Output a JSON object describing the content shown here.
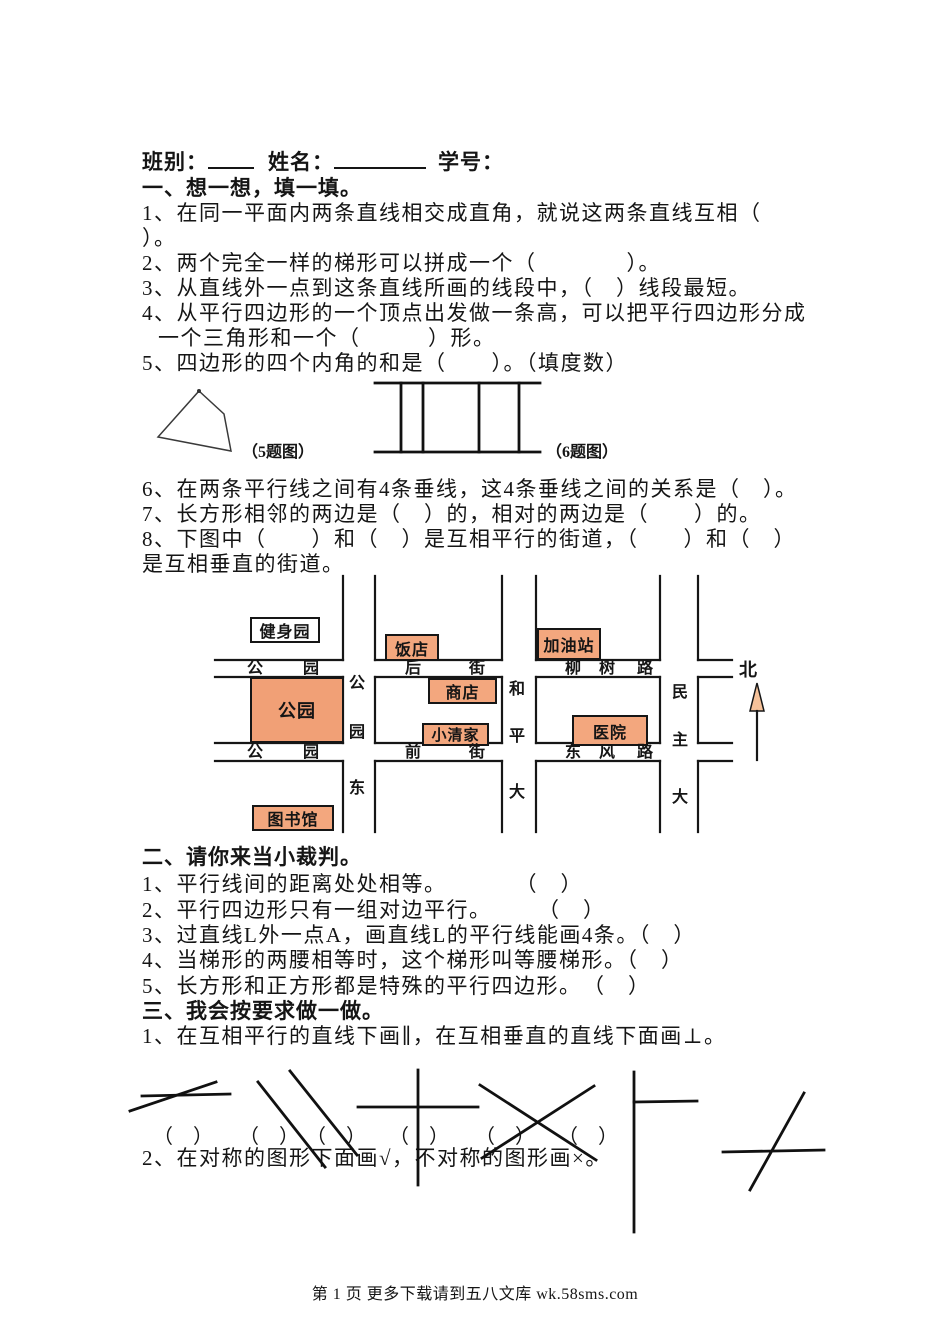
{
  "colors": {
    "building_fill": "#f3a77e",
    "park_fill": "#f1a076",
    "arrow_fill": "#f6c29a",
    "ink": "#151515"
  },
  "header": {
    "class_label": "班别：",
    "name_label": "姓名：",
    "student_label": "学号："
  },
  "s1": {
    "title": "一、想一想，填一填。",
    "q1a": "1、在同一平面内两条直线相交成直角，就说这两条直线互相（",
    "q1b": "）。",
    "q2": "2、两个完全一样的梯形可以拼成一个（　　　　）。",
    "q3": "3、从直线外一点到这条直线所画的线段中，（　）线段最短。",
    "q4a": "4、从平行四边形的一个顶点出发做一条高，可以把平行四边形分成",
    "q4b": "一个三角形和一个（　　　）形。",
    "q5": "5、四边形的四个内角的和是（　　）。（填度数）",
    "q6": "6、在两条平行线之间有4条垂线，这4条垂线之间的关系是（　）。",
    "q7": "7、长方形相邻的两边是（　）的，相对的两边是（　　）的。",
    "q8a": "8、下图中（　　）和（　）是互相平行的街道，（　　）和（　）",
    "q8b": "是互相垂直的街道。"
  },
  "figs": {
    "fig5_label": "（5题图）",
    "fig6_label": "（6题图）"
  },
  "map": {
    "north": "北",
    "h1": {
      "west": [
        "公",
        "园"
      ],
      "mid": [
        "后",
        "街"
      ],
      "east": [
        "柳",
        "树",
        "路"
      ]
    },
    "h2": {
      "west": [
        "公",
        "园"
      ],
      "mid": [
        "前",
        "街"
      ],
      "east": [
        "东",
        "风",
        "路"
      ]
    },
    "v1": [
      "公",
      "园",
      "东"
    ],
    "v2": [
      "和",
      "平",
      "大"
    ],
    "v3": [
      "民",
      "主",
      "大"
    ],
    "buildings": [
      {
        "name": "健身园"
      },
      {
        "name": "饭店"
      },
      {
        "name": "加油站"
      },
      {
        "name": "商店"
      },
      {
        "name": "公园"
      },
      {
        "name": "小清家"
      },
      {
        "name": "医院"
      },
      {
        "name": "图书馆"
      }
    ]
  },
  "s2": {
    "title": "二、请你来当小裁判。",
    "q1": "1、平行线间的距离处处相等。　　　　（　）",
    "q2": "2、平行四边形只有一组对边平行。　　　（　）",
    "q3": "3、过直线L外一点A，画直线L的平行线能画4条。（　）",
    "q4": "4、当梯形的两腰相等时，这个梯形叫等腰梯形。（　）",
    "q5": "5、长方形和正方形都是特殊的平行四边形。　（　）"
  },
  "s3": {
    "title": "三、我会按要求做一做。",
    "q1": "1、在互相平行的直线下画∥，在互相垂直的直线下面画⊥。",
    "paren": "（　）",
    "q2": "2、在对称的图形下面画√，不对称的图形画×。"
  },
  "footer": {
    "text": "第 1 页 更多下载请到五八文库 wk.58sms.com"
  }
}
